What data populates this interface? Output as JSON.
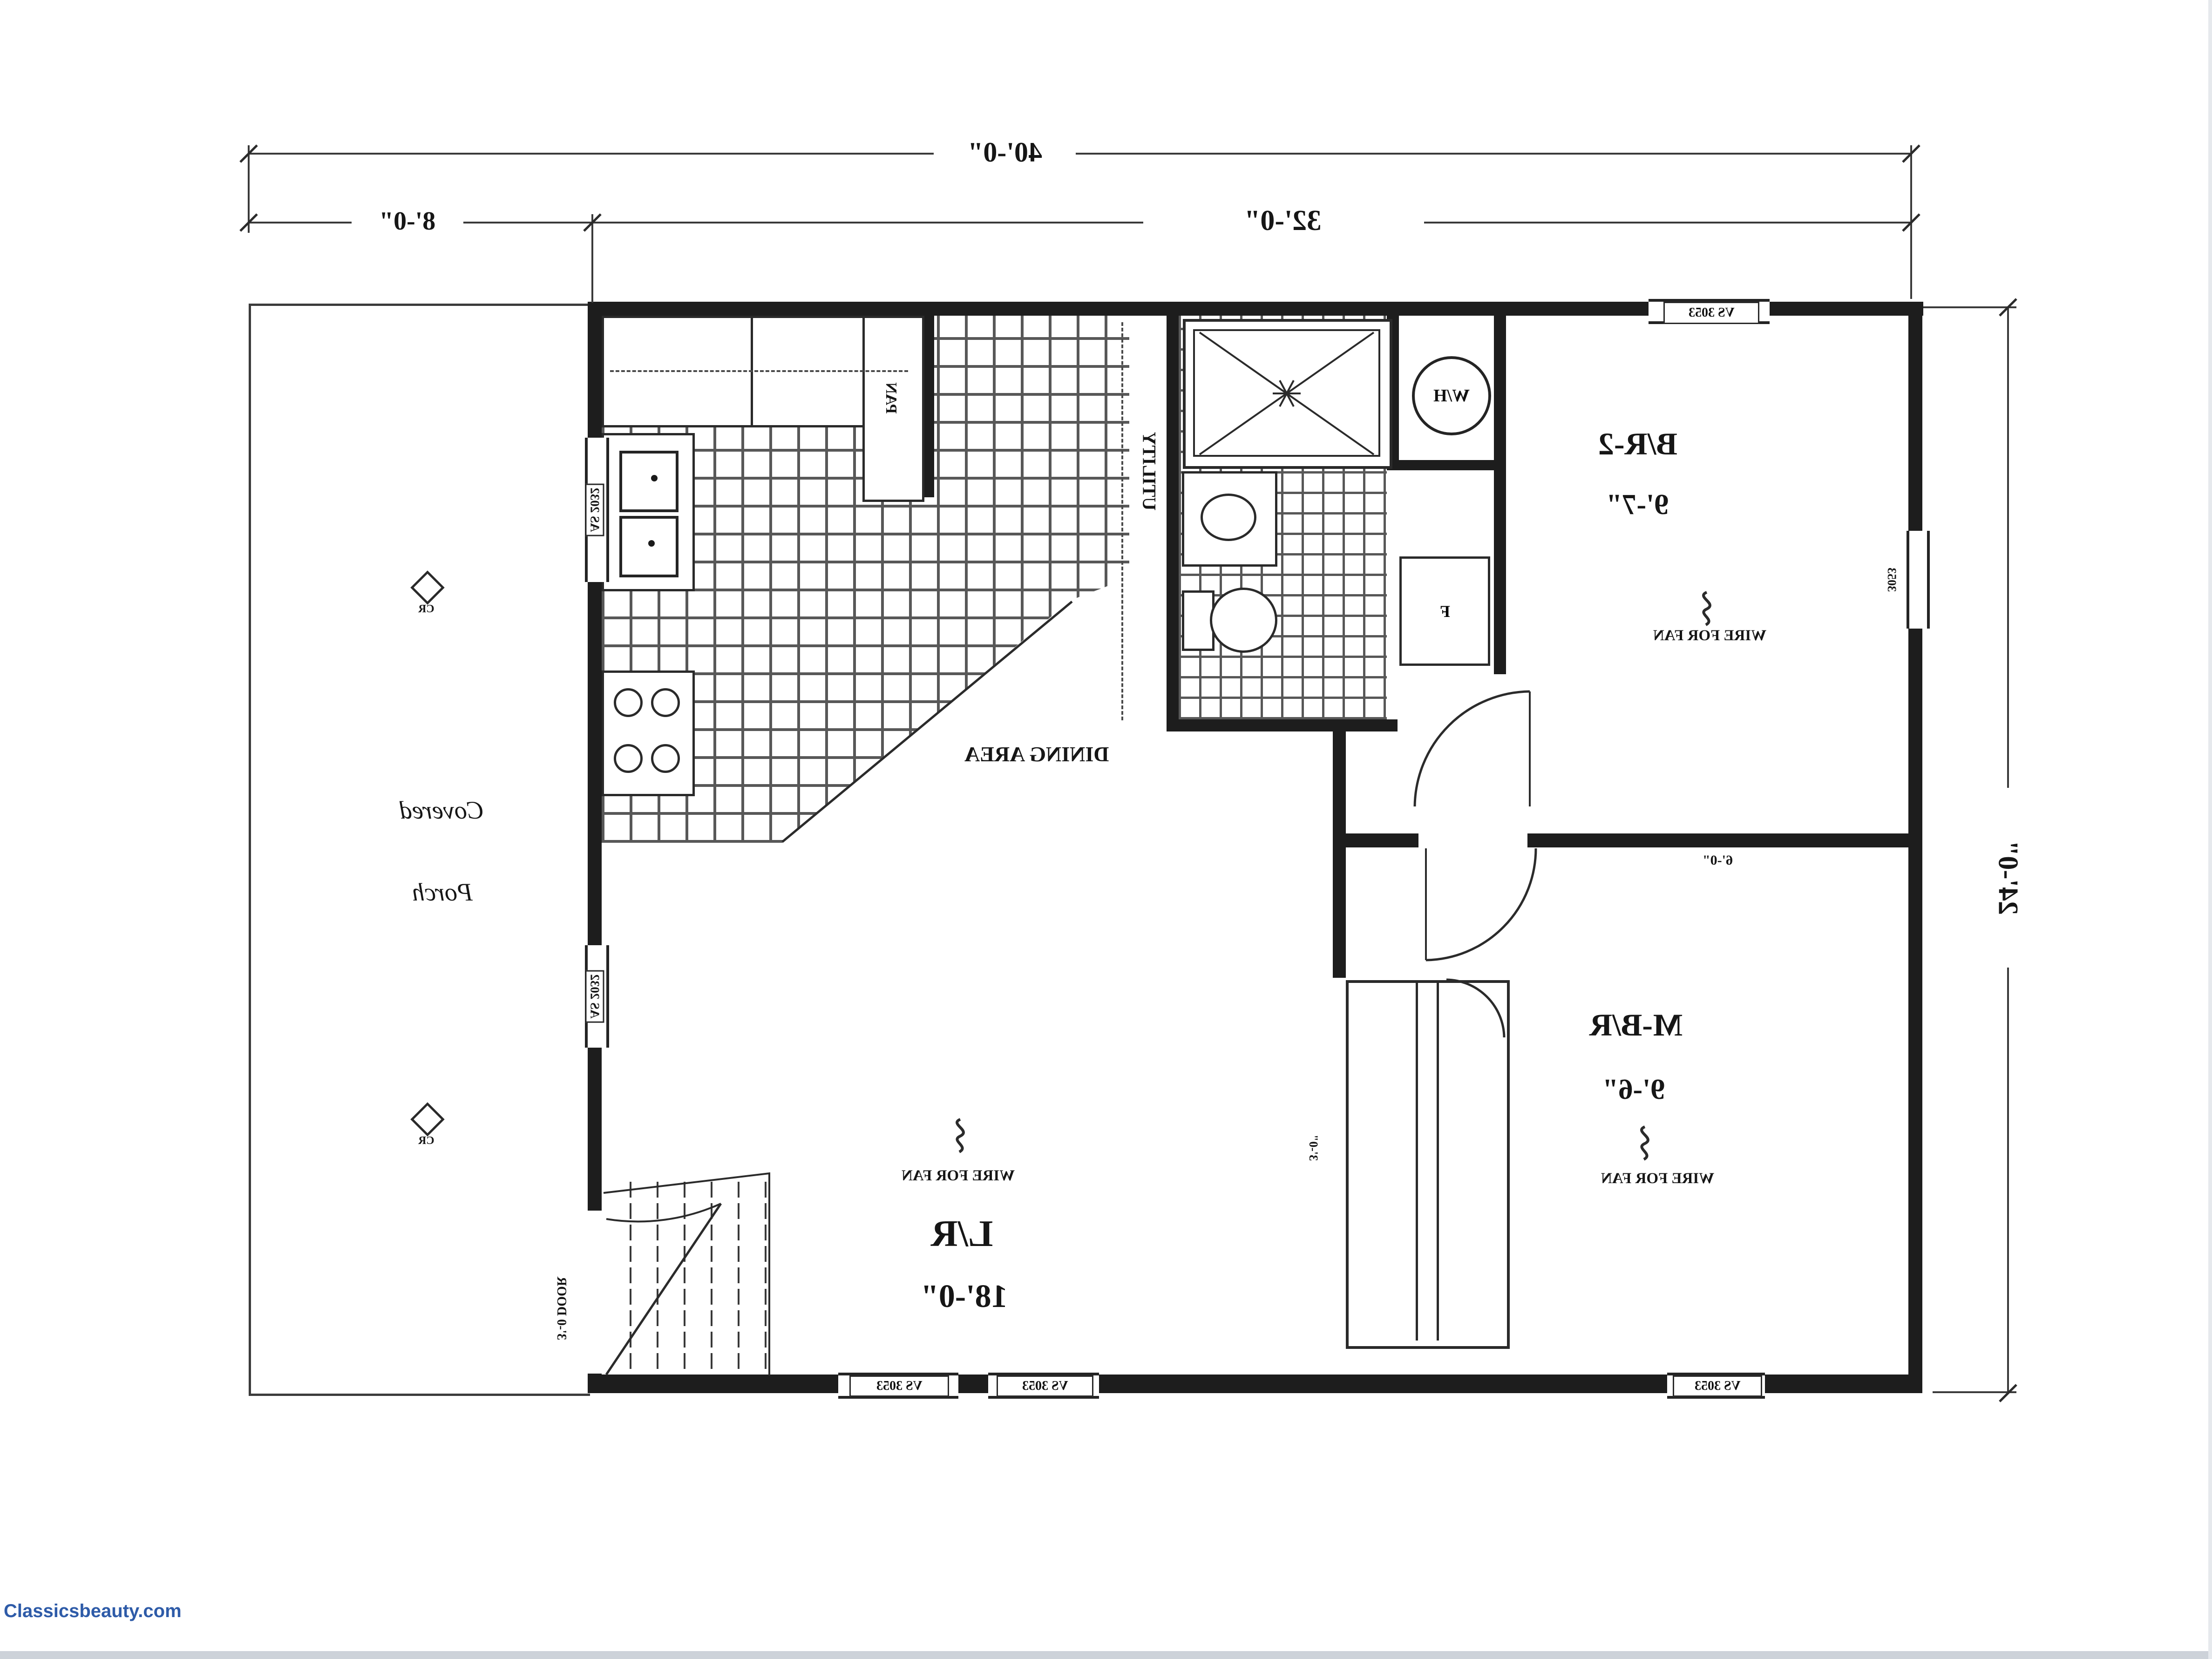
{
  "meta": {
    "watermark": "Classicsbeauty.com",
    "watermark_color": "#2e5ba8"
  },
  "dimensions": {
    "overall_width": "40'-0\"",
    "porch_width": "8'-0\"",
    "main_width": "32'-0\"",
    "depth": "24'-0\""
  },
  "rooms": {
    "bedroom2": {
      "name": "B/R-2",
      "size": "9'-7\"",
      "fan_note": "WIRE FOR FAN"
    },
    "master_bedroom": {
      "name": "M-B/R",
      "size": "9'-6\"",
      "fan_note": "WIRE FOR FAN"
    },
    "living_room": {
      "name": "L/R",
      "size": "18'-0\"",
      "fan_note": "WIRE FOR FAN"
    },
    "dining_area": {
      "name": "DINING AREA"
    },
    "covered_porch": {
      "line1": "Covered",
      "line2": "Porch"
    },
    "utility": {
      "name": "UTILITY"
    },
    "pantry": {
      "name": "PAN"
    }
  },
  "fixtures": {
    "water_heater": "W/H",
    "furnace": "F",
    "ceiling_register": "CR"
  },
  "windows": {
    "top_bedroom2": "VS 3053",
    "bottom_living_1": "VS 3053",
    "bottom_living_2": "VS 3053",
    "bottom_master": "VS 3053",
    "kitchen_left": "AS 2032",
    "living_left": "AS 2032",
    "bedroom2_right": "3053"
  },
  "doors": {
    "entry": "3'-0 DOOR",
    "bedroom_wall": "6'-0\"",
    "closet": "3'-0\""
  }
}
